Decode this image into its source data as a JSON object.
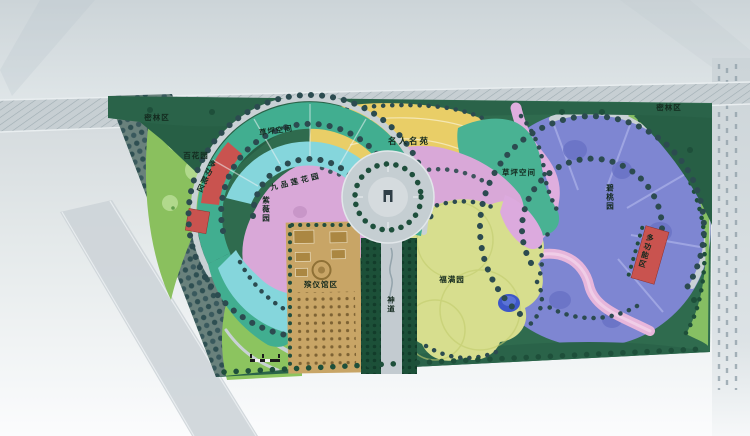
{
  "map": {
    "labels": {
      "forest_left": "密林区",
      "forest_right": "密林区",
      "flower_garden": "百花园",
      "lawn_left": "草坪空间",
      "lawn_right": "草坪空间",
      "multi_left": "多功能区",
      "multi_right": "多功能区",
      "ziwei_garden": "紫薇园",
      "lotus_garden": "九品莲花园",
      "celebrity_garden": "名人名苑",
      "bitao_garden": "碧桃园",
      "fuman_garden": "福满园",
      "funeral_hall": "殡仪馆区",
      "spirit_way": "神道"
    },
    "colors": {
      "site_green": "#2f6b4e",
      "forest_dark": "#275f45",
      "tree_dot": "#2c4b50",
      "teal_band": "#41ae90",
      "cyan_band": "#85d6dc",
      "pink_area": "#d9a8d8",
      "red_zone": "#c9534f",
      "yellow_zone": "#e9ce67",
      "green_lawn_right": "#49b293",
      "purple_zone": "#7e86d2",
      "fuman_yellowgreen": "#d7de8e",
      "tan_zone": "#c8a566",
      "light_green": "#8ac05e",
      "path_grey": "#c5ced2",
      "pond_blue": "#3e57c8",
      "road_grey": "#ccd4d8"
    }
  }
}
